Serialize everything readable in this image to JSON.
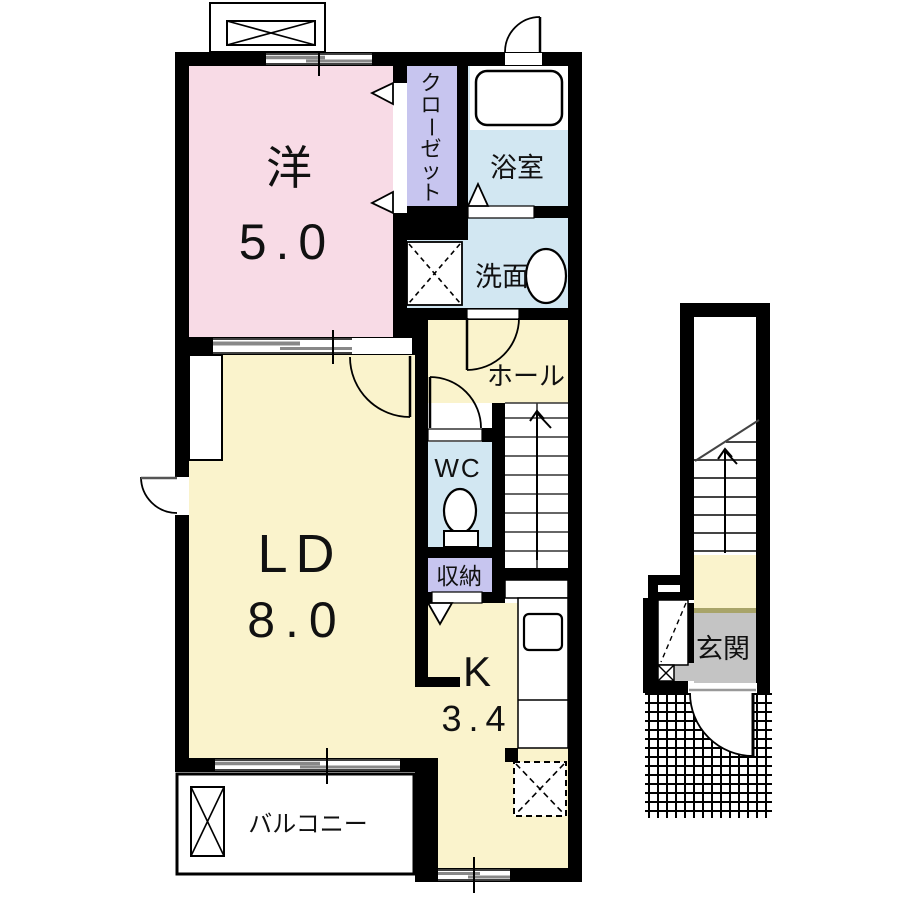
{
  "floor_plan": {
    "title": "apartment-floor-plan",
    "rooms": {
      "western": {
        "name": "洋",
        "size": "5.0"
      },
      "closet": {
        "chars": [
          "ク",
          "ロ",
          "ー",
          "ゼ",
          "ッ",
          "ト"
        ]
      },
      "bath": {
        "name": "浴室"
      },
      "washroom": {
        "name": "洗面"
      },
      "hall": {
        "name": "ホール"
      },
      "wc": {
        "name": "WC"
      },
      "storage": {
        "name": "収納"
      },
      "living_dining": {
        "name": "LD",
        "size": "8.0"
      },
      "kitchen": {
        "name": "K",
        "size": "3.4"
      },
      "balcony": {
        "name": "バルコニー"
      },
      "entrance": {
        "name": "玄関"
      }
    },
    "colors": {
      "room_pink": "#f8dbe6",
      "room_purple": "#c7c5ef",
      "room_blue": "#d2e7f2",
      "room_yellow": "#faf3cc",
      "entrance_gray": "#c4c4c4",
      "wall": "#000000"
    }
  }
}
